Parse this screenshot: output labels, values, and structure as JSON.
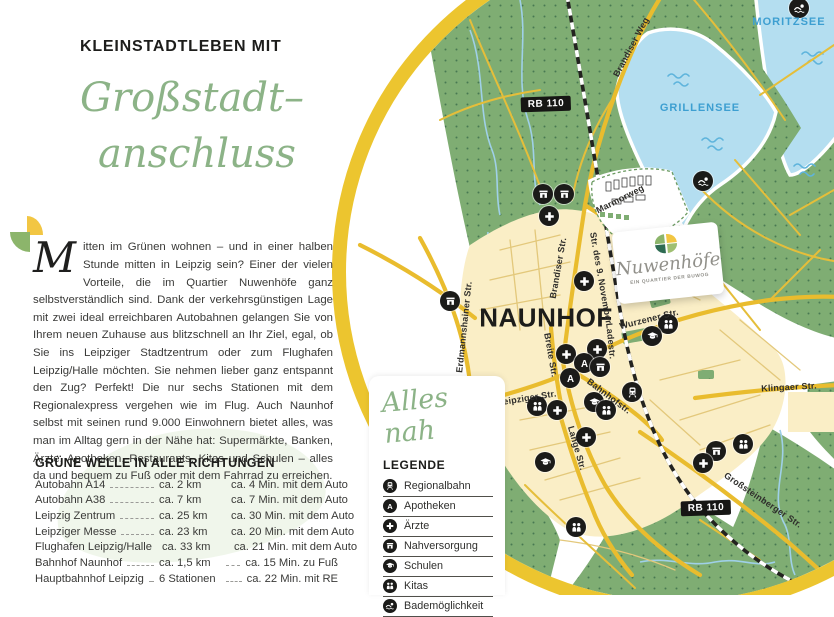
{
  "page": {
    "eyebrow": "KLEINSTADTLEBEN MIT",
    "headline_line1": "Großstadt–",
    "headline_line2": "anschluss",
    "dropcap": "M",
    "paragraph": "itten im Grünen wohnen – und in einer halben Stunde mitten in Leipzig sein? Einer der vielen Vorteile, die im Quartier Nuwenhöfe ganz selbstverständlich sind. Dank der verkehrsgünstigen Lage mit zwei ideal erreichbaren Autobahnen gelangen Sie von Ihrem neuen Zuhause aus blitzschnell an Ihr Ziel, egal, ob Sie ins Leipziger Stadtzentrum oder zum Flughafen Leipzig/Halle möchten. Sie nehmen lieber ganz entspannt den Zug? Perfekt! Die nur sechs Stationen mit dem Regionalexpress vergehen wie im Flug. Auch Naunhof selbst mit seinen rund 9.000 Einwohnern bietet alles, was man im Alltag gern in der Nähe hat: Supermärkte, Banken, Ärzte, Apotheken, Restaurants, Kitas und Schulen – alles da und bequem zu Fuß oder mit dem Fahrrad zu erreichen."
  },
  "table": {
    "heading": "GRÜNE WELLE IN ALLE RICHTUNGEN",
    "rows": [
      {
        "place": "Autobahn A14",
        "distance": "ca. 2 km",
        "time": "ca. 4 Min. mit dem Auto"
      },
      {
        "place": "Autobahn A38",
        "distance": "ca. 7 km",
        "time": "ca. 7 Min. mit dem Auto"
      },
      {
        "place": "Leipzig Zentrum",
        "distance": "ca. 25 km",
        "time": "ca. 30 Min. mit dem Auto"
      },
      {
        "place": "Leipziger Messe",
        "distance": "ca. 23 km",
        "time": "ca. 20 Min. mit dem Auto"
      },
      {
        "place": "Flughafen Leipzig/Halle",
        "distance": "ca. 33 km",
        "time": "ca. 21 Min. mit dem Auto"
      },
      {
        "place": "Bahnhof Naunhof",
        "distance": "ca. 1,5 km",
        "time": "ca. 15 Min. zu Fuß"
      },
      {
        "place": "Hauptbahnhof Leipzig",
        "distance": "6 Stationen",
        "time": "ca. 22 Min. mit RE"
      }
    ]
  },
  "legend": {
    "script_title": "Alles nah",
    "heading": "LEGENDE",
    "items": [
      {
        "kind": "train",
        "icon": "train-icon",
        "label": "Regionalbahn"
      },
      {
        "kind": "apo",
        "icon": "pharmacy-a-icon",
        "label": "Apotheken"
      },
      {
        "kind": "plus",
        "icon": "medical-cross-icon",
        "label": "Ärzte"
      },
      {
        "kind": "shop",
        "icon": "shop-icon",
        "label": "Nahversorgung"
      },
      {
        "kind": "school",
        "icon": "graduation-cap-icon",
        "label": "Schulen"
      },
      {
        "kind": "kita",
        "icon": "children-icon",
        "label": "Kitas"
      },
      {
        "kind": "swim",
        "icon": "swimmer-icon",
        "label": "Bademöglichkeit"
      }
    ]
  },
  "logo_card": {
    "name": "Nuwenhöfe",
    "tagline": "EIN QUARTIER DER BUWOG"
  },
  "map": {
    "badges": [
      {
        "text": "RB 110",
        "x": 546,
        "y": 104
      },
      {
        "text": "RB 110",
        "x": 706,
        "y": 508
      }
    ],
    "labels": [
      {
        "t": "NAUNHOF",
        "x": 546,
        "y": 318,
        "r": 0,
        "k": "city"
      },
      {
        "t": "MORITZSEE",
        "x": 789,
        "y": 22,
        "r": 0,
        "k": "water"
      },
      {
        "t": "GRILLENSEE",
        "x": 700,
        "y": 108,
        "r": 0,
        "k": "water"
      },
      {
        "t": "Brandiser Weg",
        "x": 631,
        "y": 47,
        "r": -62,
        "k": "street"
      },
      {
        "t": "Brandiser Str.",
        "x": 558,
        "y": 268,
        "r": -80,
        "k": "street"
      },
      {
        "t": "Str. des 9. November",
        "x": 601,
        "y": 278,
        "r": 80,
        "k": "street"
      },
      {
        "t": "Erdmannshainer Str.",
        "x": 464,
        "y": 327,
        "r": -84,
        "k": "street"
      },
      {
        "t": "Marmorweg",
        "x": 620,
        "y": 199,
        "r": -27,
        "k": "street"
      },
      {
        "t": "Wurzener Str.",
        "x": 649,
        "y": 319,
        "r": -14,
        "k": "street"
      },
      {
        "t": "Breite Str.",
        "x": 551,
        "y": 355,
        "r": 80,
        "k": "street"
      },
      {
        "t": "Leipziger Str.",
        "x": 527,
        "y": 398,
        "r": -9,
        "k": "street"
      },
      {
        "t": "Bahnhofstr.",
        "x": 609,
        "y": 396,
        "r": 37,
        "k": "street"
      },
      {
        "t": "Ladestr.",
        "x": 611,
        "y": 341,
        "r": 84,
        "k": "street"
      },
      {
        "t": "Lange Str.",
        "x": 577,
        "y": 448,
        "r": 74,
        "k": "street"
      },
      {
        "t": "Klingaer Str.",
        "x": 789,
        "y": 387,
        "r": -3,
        "k": "street"
      },
      {
        "t": "Großsteinberger Str.",
        "x": 763,
        "y": 500,
        "r": 34,
        "k": "street"
      }
    ],
    "markers": [
      {
        "kind": "swim",
        "x": 799,
        "y": 8
      },
      {
        "kind": "swim",
        "x": 703,
        "y": 181
      },
      {
        "kind": "shop",
        "x": 543,
        "y": 194
      },
      {
        "kind": "shop",
        "x": 564,
        "y": 194
      },
      {
        "kind": "plus",
        "x": 549,
        "y": 216
      },
      {
        "kind": "plus",
        "x": 584,
        "y": 281
      },
      {
        "kind": "shop",
        "x": 450,
        "y": 301
      },
      {
        "kind": "plus",
        "x": 566,
        "y": 354
      },
      {
        "kind": "plus",
        "x": 597,
        "y": 349
      },
      {
        "kind": "apo",
        "x": 584,
        "y": 363
      },
      {
        "kind": "apo",
        "x": 570,
        "y": 378
      },
      {
        "kind": "shop",
        "x": 600,
        "y": 367
      },
      {
        "kind": "kita",
        "x": 668,
        "y": 324
      },
      {
        "kind": "school",
        "x": 652,
        "y": 336
      },
      {
        "kind": "train",
        "x": 632,
        "y": 392
      },
      {
        "kind": "school",
        "x": 594,
        "y": 402
      },
      {
        "kind": "kita",
        "x": 606,
        "y": 410
      },
      {
        "kind": "kita",
        "x": 537,
        "y": 406
      },
      {
        "kind": "plus",
        "x": 557,
        "y": 410
      },
      {
        "kind": "plus",
        "x": 586,
        "y": 437
      },
      {
        "kind": "school",
        "x": 545,
        "y": 462
      },
      {
        "kind": "kita",
        "x": 743,
        "y": 444
      },
      {
        "kind": "shop",
        "x": 716,
        "y": 451
      },
      {
        "kind": "plus",
        "x": 703,
        "y": 463
      },
      {
        "kind": "kita",
        "x": 576,
        "y": 527
      }
    ],
    "colors": {
      "accent_green": "#8cb387",
      "ring_gold": "#ecc52f",
      "forest": "#7fad73",
      "water": "#b4def0",
      "town": "#faeec6",
      "water_label": "#3d9fd1"
    }
  }
}
